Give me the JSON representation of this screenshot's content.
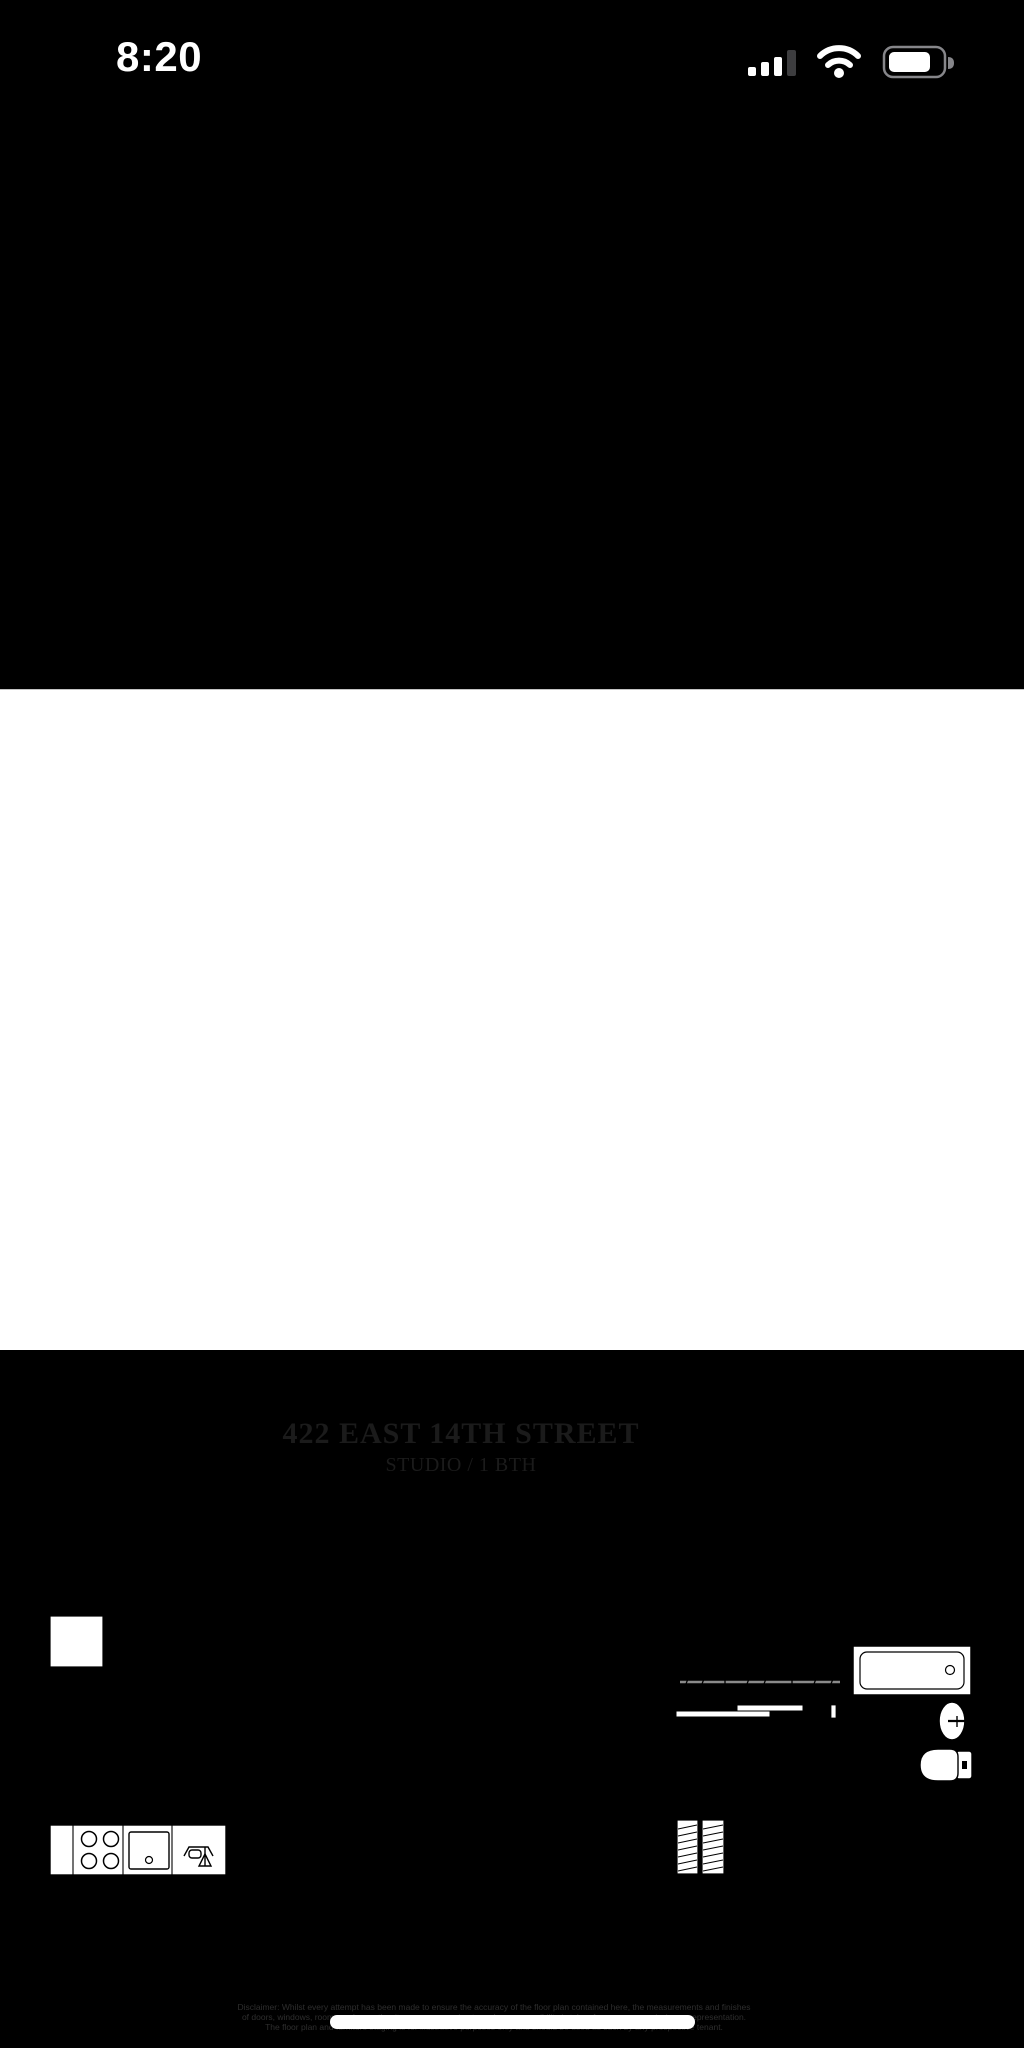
{
  "status_bar": {
    "time": "8:20",
    "icons": [
      "cellular-signal-icon",
      "wifi-icon",
      "battery-icon"
    ],
    "signal_bars_active": 3,
    "signal_bars_total": 4
  },
  "photo": {
    "title": "422 EAST 14TH STREET",
    "subtitle": "STUDIO / 1 BTH",
    "disclaimer": {
      "line1": "Disclaimer: Whilst every attempt has been made to ensure the accuracy of the floor plan contained here, the measurements and finishes",
      "line2": "of doors, windows, rooms and any other items are approximate and no responsibility is taken for any error, omission or representation.",
      "line3": "The floor plan and furniture staging is for illustrative purposes only and should be used as such by any prospective tenant."
    },
    "floor_plan": {
      "type": "studio apartment floor plan",
      "areas": [
        "main room",
        "kitchenette",
        "entry nook with shelving",
        "wardrobe closet with hanging rod",
        "hallway",
        "bathroom"
      ],
      "fixtures": [
        "four-burner stove",
        "kitchen sink",
        "kitchen faucet",
        "closet rod with hangers",
        "sliding closet doors",
        "bathtub",
        "bathroom sink",
        "toilet"
      ],
      "window_count": 2,
      "door_count": 3
    }
  },
  "colors": {
    "screen_background": "#000000",
    "photo_background": "#ffffff",
    "plan_line": "#000000",
    "status_text": "#ffffff",
    "signal_inactive_bar": "#3d3d3f",
    "battery_outline": "#86868a",
    "closet_rod": "#8a8a8a"
  }
}
